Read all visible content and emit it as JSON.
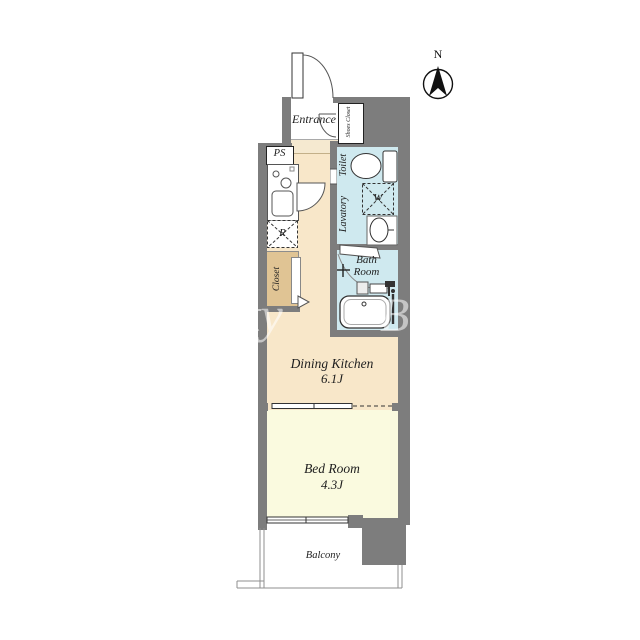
{
  "floorplan": {
    "compass": {
      "label": "N"
    },
    "rooms": {
      "entrance": {
        "label": "Entrance"
      },
      "shoes_closet": {
        "label": "Shoes Closet"
      },
      "pipe_space": {
        "label": "PS"
      },
      "refrigerator_space": {
        "label": "R"
      },
      "closet": {
        "label": "Closet"
      },
      "toilet": {
        "label": "Toilet"
      },
      "lavatory": {
        "label": "Lavatory"
      },
      "washer_space": {
        "label": "W"
      },
      "bath": {
        "line1": "Bath",
        "line2": "Room"
      },
      "dining_kitchen": {
        "label": "Dining Kitchen",
        "size": "6.1J"
      },
      "bedroom": {
        "label": "Bed Room",
        "size": "4.3J"
      },
      "balcony": {
        "label": "Balcony"
      }
    },
    "watermark": {
      "part1": "erty",
      "part2": "B"
    },
    "colors": {
      "wall": "#7d7d7d",
      "floor_beige": "#f8e7c9",
      "bedroom_yellow": "#fafadf",
      "wet_area_blue": "#cfe9ef",
      "closet_tan": "#e0c494",
      "entrance_step": "#f5e9d0",
      "line_dark": "#333333"
    }
  }
}
